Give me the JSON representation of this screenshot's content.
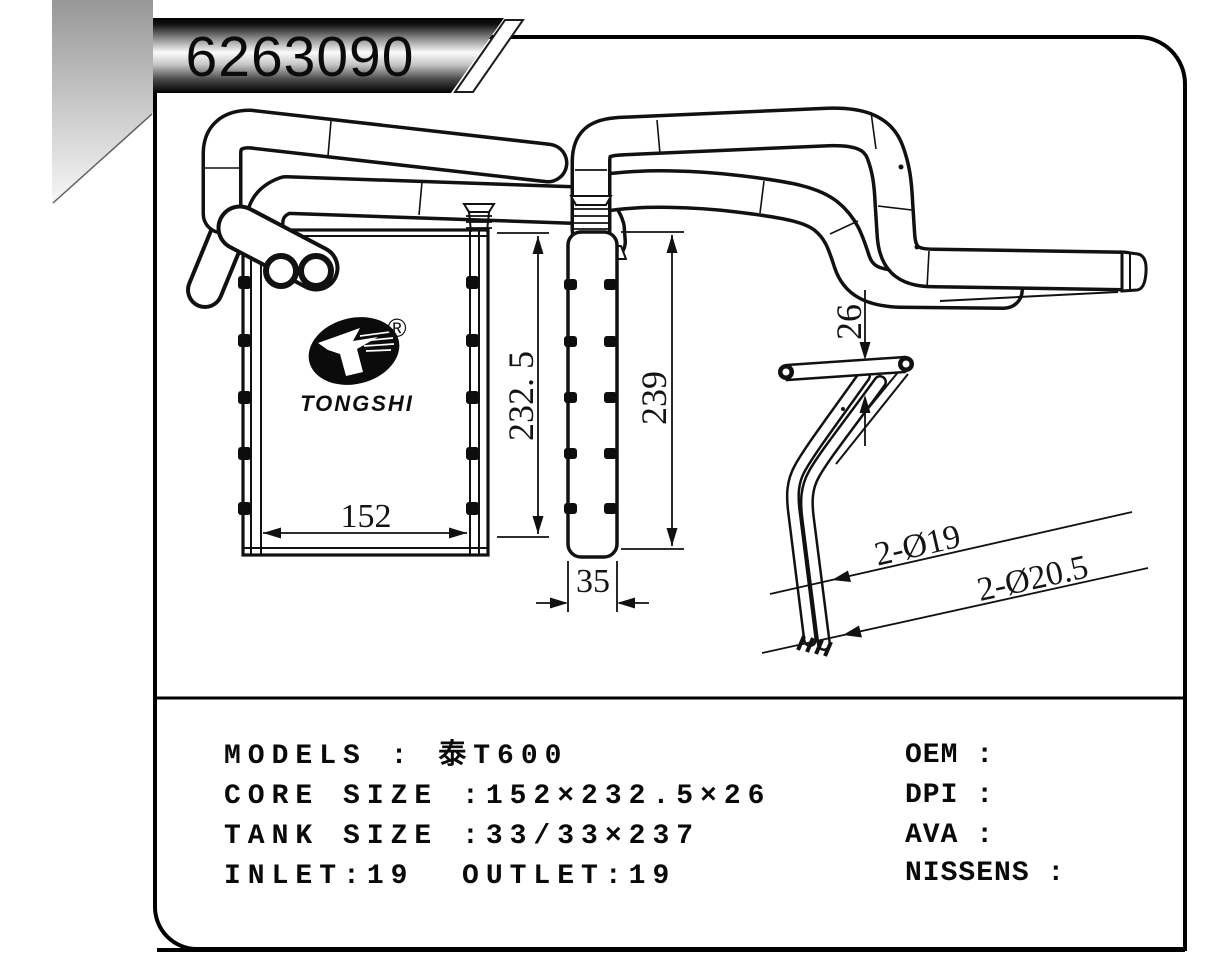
{
  "banner": {
    "part_number": "6263090"
  },
  "logo": {
    "brand": "TONGSHI",
    "registered_mark": "®"
  },
  "drawing": {
    "dim_core_width": "152",
    "dim_core_height": "232. 5",
    "dim_overall_height": "239",
    "dim_tank_width": "35",
    "dim_pipe_offset": "26",
    "dim_pipe_dia_inner": "2-Ø19",
    "dim_pipe_dia_outer": "2-Ø20.5"
  },
  "specs": {
    "left": [
      "MODELS : 泰T600",
      "CORE SIZE :152×232.5×26",
      "TANK SIZE :33/33×237",
      "INLET:19  OUTLET:19"
    ],
    "right": [
      "OEM :",
      "DPI :",
      "AVA :",
      "NISSENS :"
    ]
  }
}
